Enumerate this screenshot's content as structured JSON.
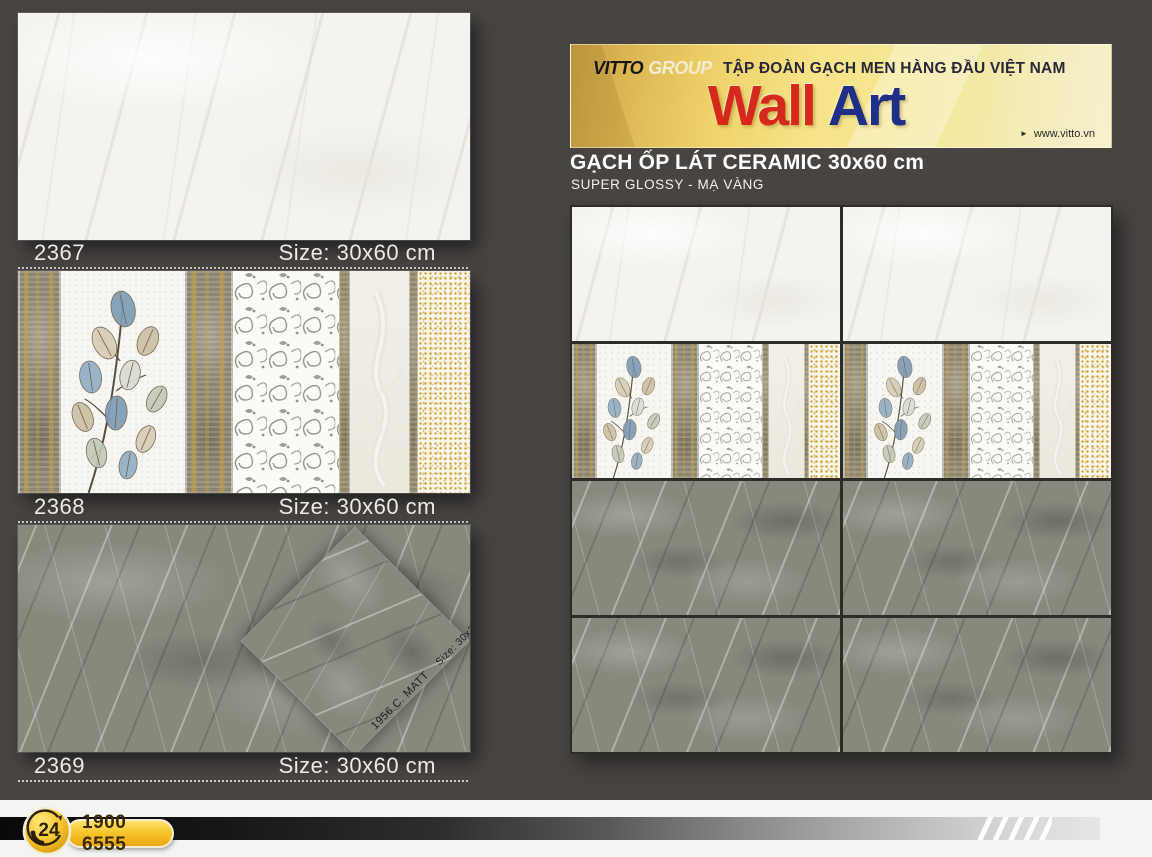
{
  "colors": {
    "background": "#474442",
    "banner_gold": "#f2d977",
    "brand_red": "#d7281c",
    "brand_blue": "#1e2f85",
    "accent_gold": "#f0b51c",
    "grout_dark": "#2e2c29"
  },
  "left_products": [
    {
      "code": "2367",
      "size_label": "Size: 30x60 cm",
      "finish": "white-marble"
    },
    {
      "code": "2368",
      "size_label": "Size: 30x60 cm",
      "finish": "decor-leaf-strip"
    },
    {
      "code": "2369",
      "size_label": "Size: 30x60 cm",
      "finish": "gray-marble",
      "overlay_code": "1956 C. MATT",
      "overlay_size": "Size: 30x30 cm"
    }
  ],
  "banner": {
    "brand": "VITTO",
    "brand_suffix": "GROUP",
    "tagline": "TẬP ĐOÀN GẠCH MEN HÀNG ĐẦU VIỆT NAM",
    "wordmark_1": "Wall",
    "wordmark_2": "Art",
    "website_arrow": "►",
    "website": "www.vitto.vn"
  },
  "section": {
    "title": "GẠCH ỐP LÁT CERAMIC 30x60 cm",
    "subtitle": "SUPER GLOSSY - MẠ VÀNG"
  },
  "wall_grid": {
    "columns": 2,
    "rows": [
      "white-marble",
      "decor-leaf-strip",
      "gray-marble",
      "gray-marble"
    ]
  },
  "footer": {
    "badge_text": "24",
    "hotline": "1900 6555"
  }
}
